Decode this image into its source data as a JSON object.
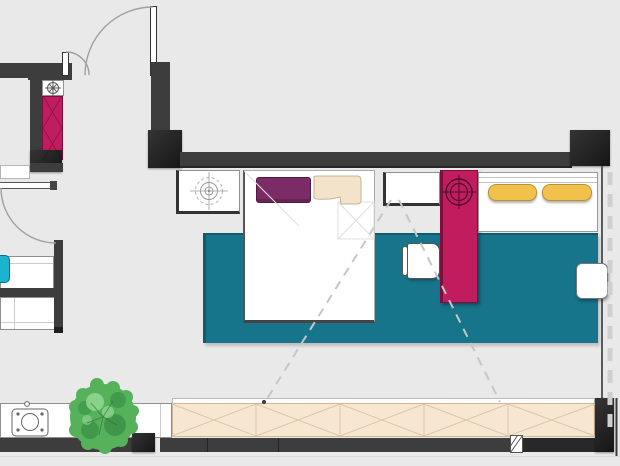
{
  "colors": {
    "background": "#e9e9e9",
    "wall": "#3d3d3d",
    "wall_dark": "#161616",
    "magenta": "#c11d5e",
    "magenta_edge": "#7c0f3d",
    "rug": "#16758a",
    "cyan": "#1cb3d1",
    "yellow": "#f0c14b",
    "yellow_edge": "#b8923a",
    "plum": "#7d2b66",
    "cream": "#f3e3cb",
    "bench": "#f8e7d0",
    "bench_line": "#dcc6ab",
    "tree": "#55b25b",
    "tree_dark": "#2e7d3b",
    "tree_light": "#96d996",
    "white": "#ffffff",
    "outline": "#8f8f8f",
    "arc": "#a0a0a0",
    "dashed": "#c6c6c6",
    "icon": "#5a5a5a"
  },
  "icons": {
    "ceiling_fan_icon": "compass-rose circle with radiating spokes",
    "ceiling_light_icon": "concentric circles with crosshair (dashed outer ring)",
    "spotlight_icon": "double circle with crosshair on wardrobe",
    "stove_icon": "rounded square with burner circle and four dots",
    "knob_icon": "small circle on counter edge",
    "section_marker_icon": "small white rectangle with diagonal hatch",
    "tree_icon": "mottled green canopy circle",
    "door_arc_icon": "quarter-circle door swing",
    "window_icon": "dashed glazing line along right wall"
  }
}
